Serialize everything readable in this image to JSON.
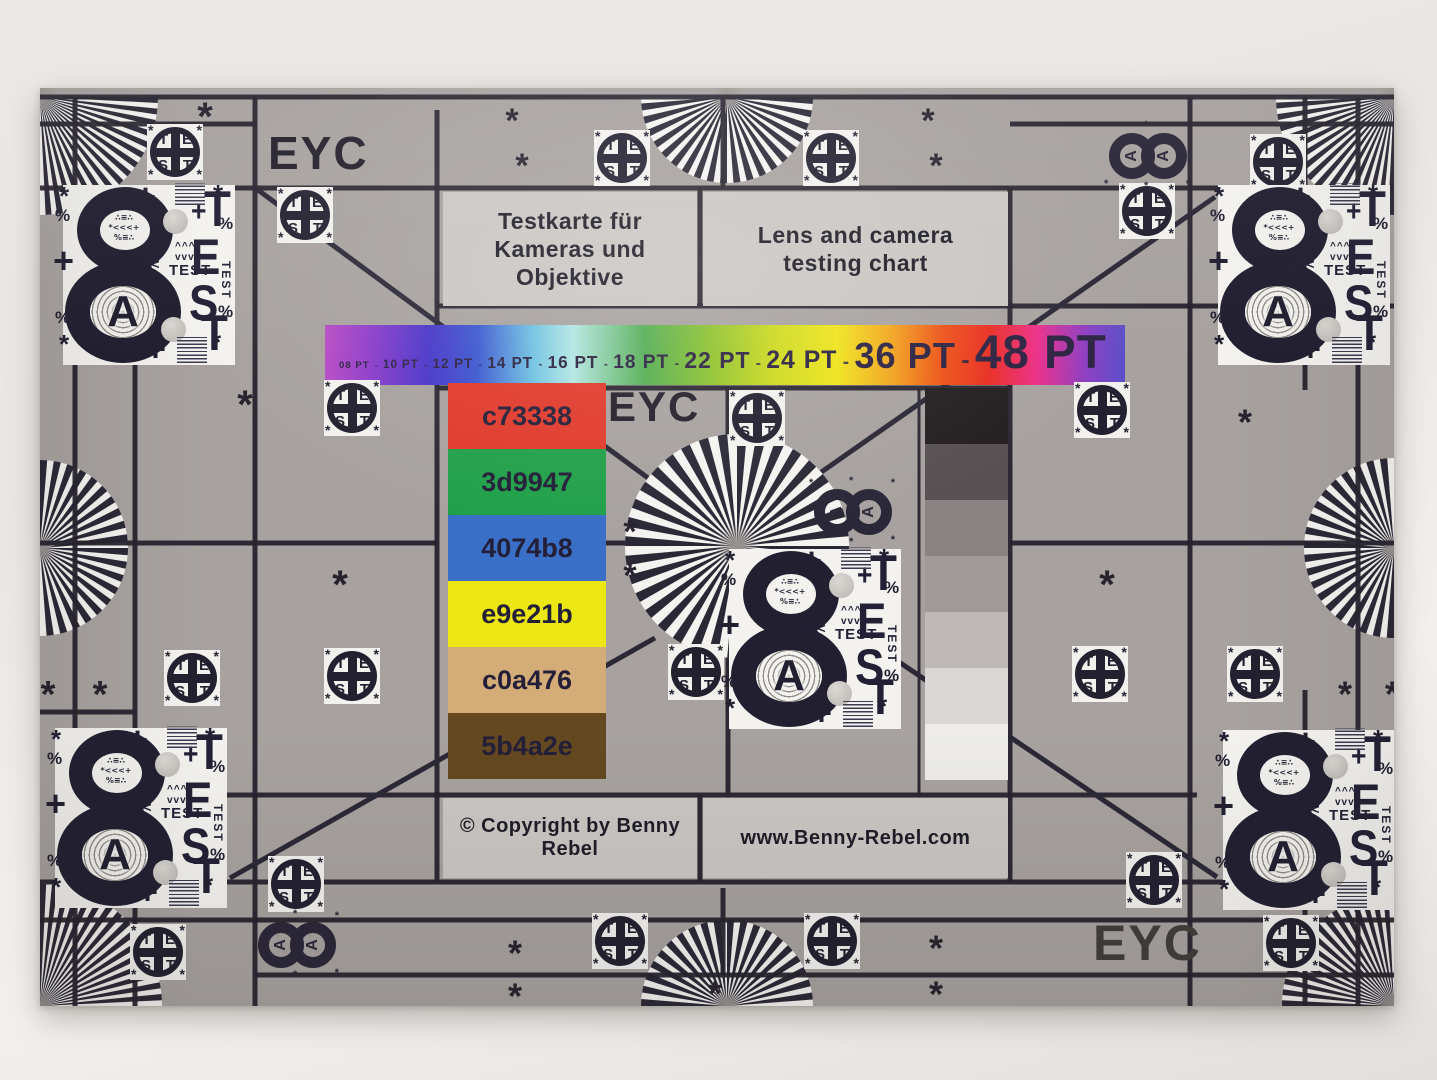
{
  "chart": {
    "brand_top": "EYC",
    "brand_mid": "EYC",
    "brand_bottom": "EYC",
    "title_de": [
      "Testkarte für",
      "Kameras und Objektive"
    ],
    "title_en": [
      "Lens and camera",
      "testing chart"
    ],
    "copyright": "© Copyright by Benny Rebel",
    "website": "www.Benny-Rebel.com",
    "separator": "-",
    "pt_scale": [
      {
        "pt": 8,
        "label": "08 PT"
      },
      {
        "pt": 10,
        "label": "10 PT"
      },
      {
        "pt": 12,
        "label": "12 PT"
      },
      {
        "pt": 14,
        "label": "14 PT"
      },
      {
        "pt": 16,
        "label": "16 PT"
      },
      {
        "pt": 18,
        "label": "18 PT"
      },
      {
        "pt": 22,
        "label": "22 PT"
      },
      {
        "pt": 24,
        "label": "24 PT"
      },
      {
        "pt": 36,
        "label": "36 PT"
      },
      {
        "pt": 48,
        "label": "48 PT"
      }
    ],
    "color_patches": [
      {
        "label": "c73338",
        "fill": "#e03a2c"
      },
      {
        "label": "3d9947",
        "fill": "#21a04a"
      },
      {
        "label": "4074b8",
        "fill": "#3a6fc8"
      },
      {
        "label": "e9e21b",
        "fill": "#ece613"
      },
      {
        "label": "c0a476",
        "fill": "#d4ac77"
      },
      {
        "label": "5b4a2e",
        "fill": "#64481f"
      }
    ],
    "grayscale_steps": [
      "#241f20",
      "#585052",
      "#8a8283",
      "#a09a9a",
      "#bdb8b7",
      "#dad8d6",
      "#edecea"
    ],
    "rainbow_stops": [
      "#b94cc4",
      "#8a3cca",
      "#4835c8",
      "#3b57cf",
      "#6ec2e2",
      "#b2e6e2",
      "#53ad52",
      "#8cc22f",
      "#ccd91e",
      "#efe41b",
      "#f2a21e",
      "#ec5418",
      "#e92e22",
      "#ec2f8a",
      "#8e3fc2",
      "#5c4fc9"
    ],
    "test_block": {
      "letter": "A",
      "col_letters": [
        "T",
        "E",
        "S",
        "T"
      ],
      "word": "TEST",
      "side_word": "TEST",
      "plus": "+",
      "percent": "%",
      "arrows": "<<<",
      "carets_up": "^^^",
      "carets_down": "vvv",
      "noise1": "∴≡∴",
      "noise2": "*<<<+",
      "noise3": "%≡∴"
    },
    "test_circle_letters": [
      "T",
      "E",
      "S",
      "T"
    ],
    "asterisk": "*",
    "palette": {
      "card": "#a7a29f",
      "line": "#26232e",
      "panel": "#cac6c3",
      "paper_white": "#f3f2ef",
      "ink": "#232030"
    }
  }
}
